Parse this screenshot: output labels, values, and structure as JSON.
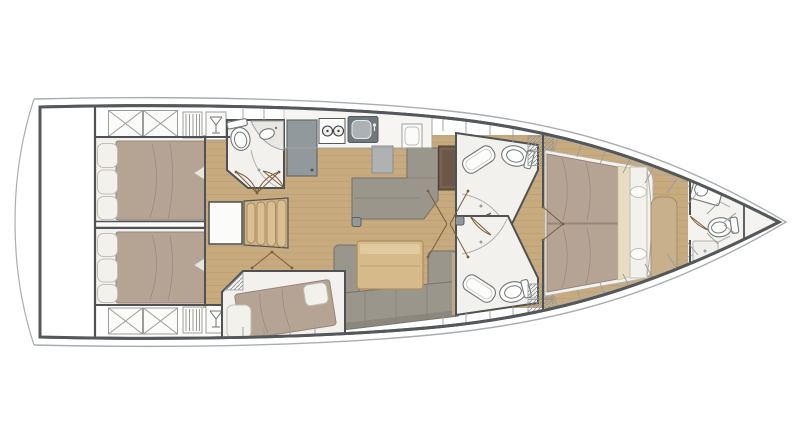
{
  "canvas": {
    "width": 800,
    "height": 446
  },
  "diagram": {
    "type": "yacht-deck-floorplan",
    "orientation": "bow-right",
    "areas": [
      "stern-garage",
      "aft-cabin-port",
      "aft-cabin-starboard",
      "aft-head",
      "galley",
      "companionway",
      "nav-station",
      "saloon-dinette",
      "mid-cabin",
      "head-port",
      "head-starboard",
      "owners-cabin",
      "bow-head"
    ],
    "fixtures": [
      "toilet",
      "washbasin",
      "shower",
      "stove",
      "sink",
      "fridge",
      "stairs",
      "double-berth",
      "sofa",
      "table",
      "chart-desk",
      "bench",
      "mast-step",
      "deck-locker",
      "wine-glass-locker",
      "vent-locker"
    ]
  },
  "colors": {
    "hull_outline": "#54585a",
    "hull_sheer": "#a9adaf",
    "deck_band": "#ebebe7",
    "deck_box": "#fbfbf9",
    "deck_line": "#9c9d98",
    "wood": "#c7ab7f",
    "wood_line": "#b0905f",
    "wall": "#4e5254",
    "white_room": "#f2f1ed",
    "mattress": "#b5a394",
    "mattress_line": "#97857a",
    "pillow": "#f3f1ec",
    "pillow_line": "#c2beb4",
    "sofa": "#9a968b",
    "sofa_dark": "#7d7970",
    "table_wood": "#d6ba8a",
    "table_wood_light": "#e3cda3",
    "desk": "#6d5847",
    "counter": "#f6f5f2",
    "appliance": "#91999d",
    "appliance_dark": "#6e787d",
    "bench": "#c9b08c",
    "fixture": "#70767a",
    "hatch": "#8b9094",
    "door": "#7c5c3a",
    "cream": "#e8ddc3"
  }
}
